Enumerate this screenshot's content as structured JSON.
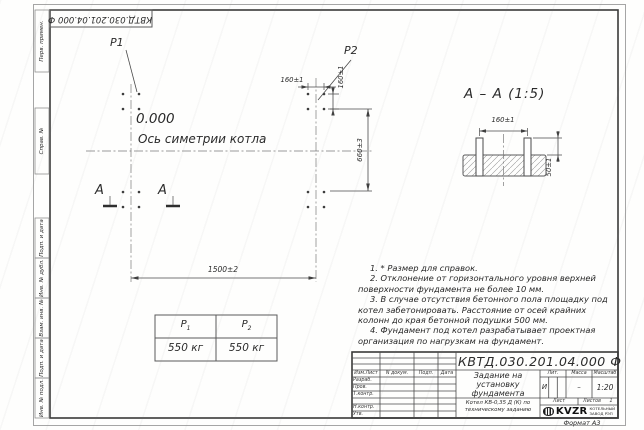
{
  "sheet": {
    "stamp_number": "КВТД.030.201.04.000 Ф",
    "format_note": "Формат А3"
  },
  "margin_labels": {
    "first_use": "Перв. примен.",
    "ref_no": "Справ. №",
    "sign_date_1": "Подп. и дата",
    "inv_dupl": "Инв. № дубл.",
    "repl_inv": "Взам. инв. №",
    "sign_date_2": "Подп. и дата",
    "inv_orig": "Инв. № подл."
  },
  "plan": {
    "p1": "P1",
    "p2": "P2",
    "level": "0.000",
    "axis_caption": "Ось симетрии котла",
    "dim_width": "1500±2",
    "dim_height": "660±3",
    "dim_bolt_h": "160±1",
    "dim_bolt_v": "160±1",
    "cut_letter_left": "A",
    "cut_letter_right": "A"
  },
  "section": {
    "title": "А – А (1:5)",
    "dim_span": "160±1",
    "dim_protrusion": "50±1"
  },
  "loads_table": {
    "col1": {
      "symbol": "P",
      "sub": "1",
      "value": "550 кг"
    },
    "col2": {
      "symbol": "P",
      "sub": "2",
      "value": "550 кг"
    }
  },
  "notes": [
    "1. * Размер для справок.",
    "2. Отклонение от горизонтального уровня верхней поверхности фундамента не более 10 мм.",
    "3. В случае отсутствия бетонного пола площадку под котел забетонировать. Расстояние от осей крайних колонн до края бетонной подушки 500 мм.",
    "4. Фундамент под котел разрабатывает проектная организация по нагрузкам на фундамент."
  ],
  "title_block": {
    "doc_number": "КВТД.030.201.04.000 Ф",
    "title_line1": "Задание на",
    "title_line2": "установку",
    "title_line3": "фундамента",
    "product_line1": "Котел КВ-0,35 Д (К) по",
    "product_line2": "техническому заданию",
    "col_izm": "Изм.Лист",
    "col_doc": "N докум.",
    "col_sign": "Подп.",
    "col_date": "Дата",
    "row_developed": "Разраб.",
    "row_checked": "Пров.",
    "row_tcontrol": "Т.контр.",
    "row_ncontrol": "Н.контр.",
    "row_approved": "Утв.",
    "lit_label": "Лит.",
    "mass_label": "Масса",
    "scale_label": "Масштаб",
    "lit_value": "И",
    "mass_value": "–",
    "scale_value": "1:20",
    "sheet_label": "Лист",
    "sheets_label": "Листов",
    "sheets_value": "1",
    "logo_text": "KVZR",
    "logo_caption_line1": "КОТЕЛЬНЫЙ",
    "logo_caption_line2": "ЗАВОД РЭП"
  }
}
